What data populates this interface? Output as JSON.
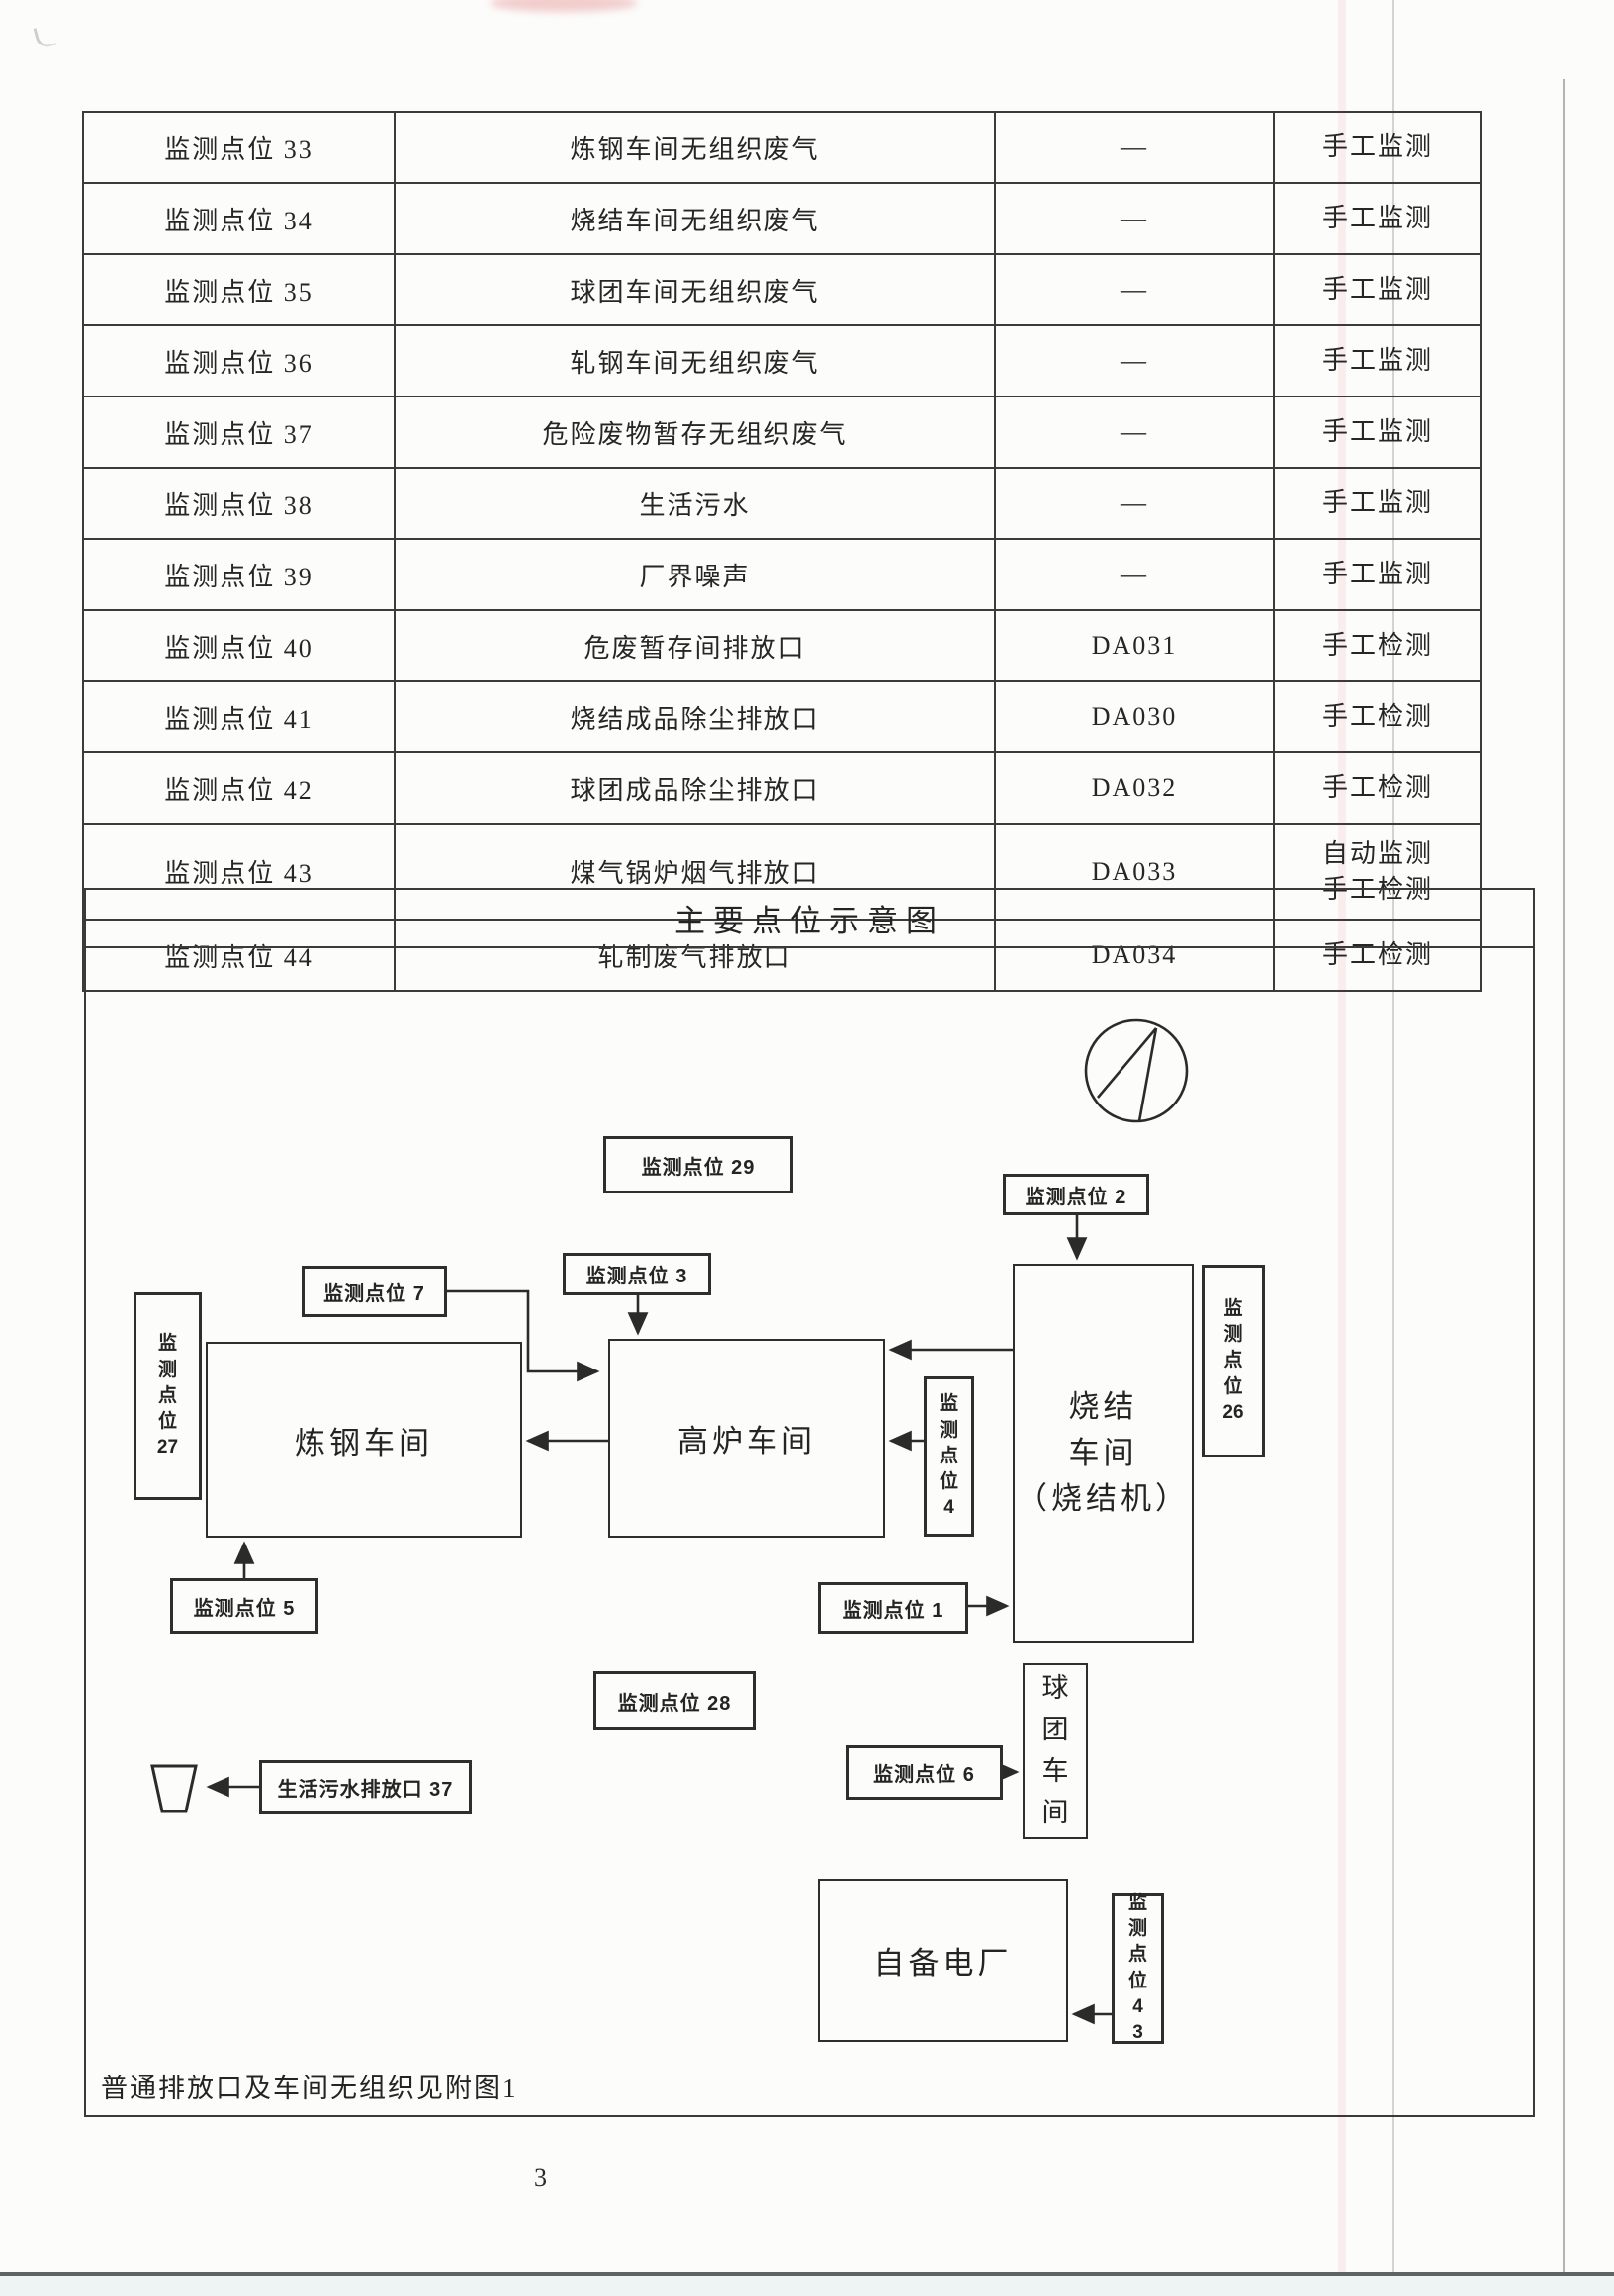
{
  "page": {
    "number": "3"
  },
  "table": {
    "rows": [
      {
        "point": "监测点位 33",
        "source": "炼钢车间无组织废气",
        "outlet": "—",
        "methods": [
          "手工监测"
        ]
      },
      {
        "point": "监测点位 34",
        "source": "烧结车间无组织废气",
        "outlet": "—",
        "methods": [
          "手工监测"
        ]
      },
      {
        "point": "监测点位 35",
        "source": "球团车间无组织废气",
        "outlet": "—",
        "methods": [
          "手工监测"
        ]
      },
      {
        "point": "监测点位 36",
        "source": "轧钢车间无组织废气",
        "outlet": "—",
        "methods": [
          "手工监测"
        ]
      },
      {
        "point": "监测点位 37",
        "source": "危险废物暂存无组织废气",
        "outlet": "—",
        "methods": [
          "手工监测"
        ]
      },
      {
        "point": "监测点位 38",
        "source": "生活污水",
        "outlet": "—",
        "methods": [
          "手工监测"
        ]
      },
      {
        "point": "监测点位 39",
        "source": "厂界噪声",
        "outlet": "—",
        "methods": [
          "手工监测"
        ]
      },
      {
        "point": "监测点位 40",
        "source": "危废暂存间排放口",
        "outlet": "DA031",
        "methods": [
          "手工检测"
        ]
      },
      {
        "point": "监测点位 41",
        "source": "烧结成品除尘排放口",
        "outlet": "DA030",
        "methods": [
          "手工检测"
        ]
      },
      {
        "point": "监测点位 42",
        "source": "球团成品除尘排放口",
        "outlet": "DA032",
        "methods": [
          "手工检测"
        ]
      },
      {
        "point": "监测点位 43",
        "source": "煤气锅炉烟气排放口",
        "outlet": "DA033",
        "methods": [
          "自动监测",
          "手工检测"
        ]
      },
      {
        "point": "监测点位 44",
        "source": "轧制废气排放口",
        "outlet": "DA034",
        "methods": [
          "手工检测"
        ]
      }
    ]
  },
  "diagram": {
    "title": "主要点位示意图",
    "note": "普通排放口及车间无组织见附图1",
    "boxes": {
      "point29": {
        "label": "监测点位 29"
      },
      "point2": {
        "label": "监测点位 2"
      },
      "point7": {
        "label": "监测点位 7"
      },
      "point3": {
        "label": "监测点位 3"
      },
      "point5": {
        "label": "监测点位 5"
      },
      "point1": {
        "label": "监测点位 1"
      },
      "point28": {
        "label": "监测点位 28"
      },
      "point6": {
        "label": "监测点位 6"
      },
      "sewage37": {
        "label": "生活污水排放口 37"
      },
      "steel": {
        "label": "炼钢车间"
      },
      "furnace": {
        "label": "高炉车间"
      },
      "power": {
        "label": "自备电厂"
      },
      "sinter": {
        "lines": [
          "烧结",
          "车间",
          "（烧结机）"
        ]
      },
      "pellet": {
        "lines": [
          "球",
          "团",
          "车",
          "间"
        ]
      },
      "point27": {
        "lines": [
          "监",
          "测",
          "点",
          "位",
          "27"
        ]
      },
      "point26": {
        "lines": [
          "监",
          "测",
          "点",
          "位",
          "26"
        ]
      },
      "point4": {
        "lines": [
          "监",
          "测",
          "点",
          "位",
          "4"
        ]
      },
      "point43": {
        "lines": [
          "监",
          "测",
          "点",
          "位",
          "4",
          "3"
        ]
      }
    }
  }
}
